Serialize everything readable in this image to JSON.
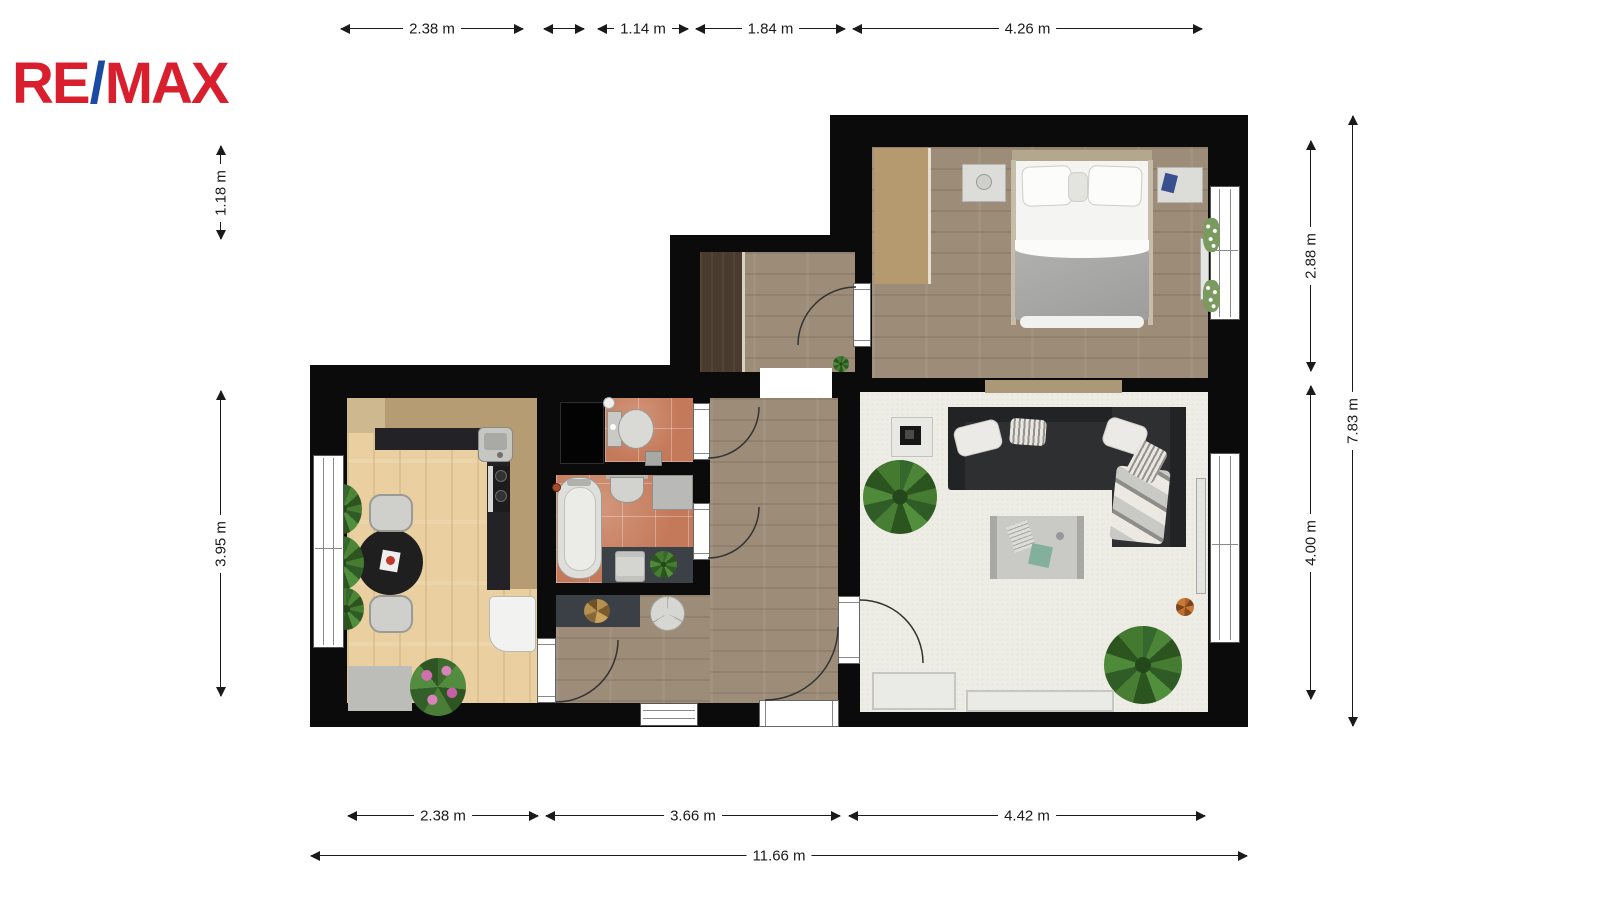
{
  "logo": {
    "part1": "RE",
    "slash": "/",
    "part2": "MAX"
  },
  "dimensions": {
    "top": [
      {
        "label": "2.38 m"
      },
      {
        "label": ""
      },
      {
        "label": "1.14 m"
      },
      {
        "label": "1.84 m"
      },
      {
        "label": "4.26 m"
      }
    ],
    "left": [
      {
        "label": "1.18 m"
      },
      {
        "label": "3.95 m"
      }
    ],
    "right": [
      {
        "label": "2.88 m"
      },
      {
        "label": "4.00 m"
      },
      {
        "label": "7.83 m"
      }
    ],
    "bottom": [
      {
        "label": "2.38 m"
      },
      {
        "label": "3.66 m"
      },
      {
        "label": "4.42 m"
      },
      {
        "label": "11.66 m"
      }
    ]
  },
  "palette": {
    "brand_red": "#d91f2e",
    "brand_blue": "#1b4aa2",
    "wall": "#0b0b0b",
    "kitchen_floor": "#ead0a0",
    "gray_wood_floor": "#9c8c78",
    "tile_floor": "#c4795a",
    "living_floor": "#edece5",
    "cabinet_tan": "#b69c73",
    "counter_dark": "#232327",
    "sofa_dark": "#2d2f31",
    "dimension_line": "#1a1a1a"
  }
}
